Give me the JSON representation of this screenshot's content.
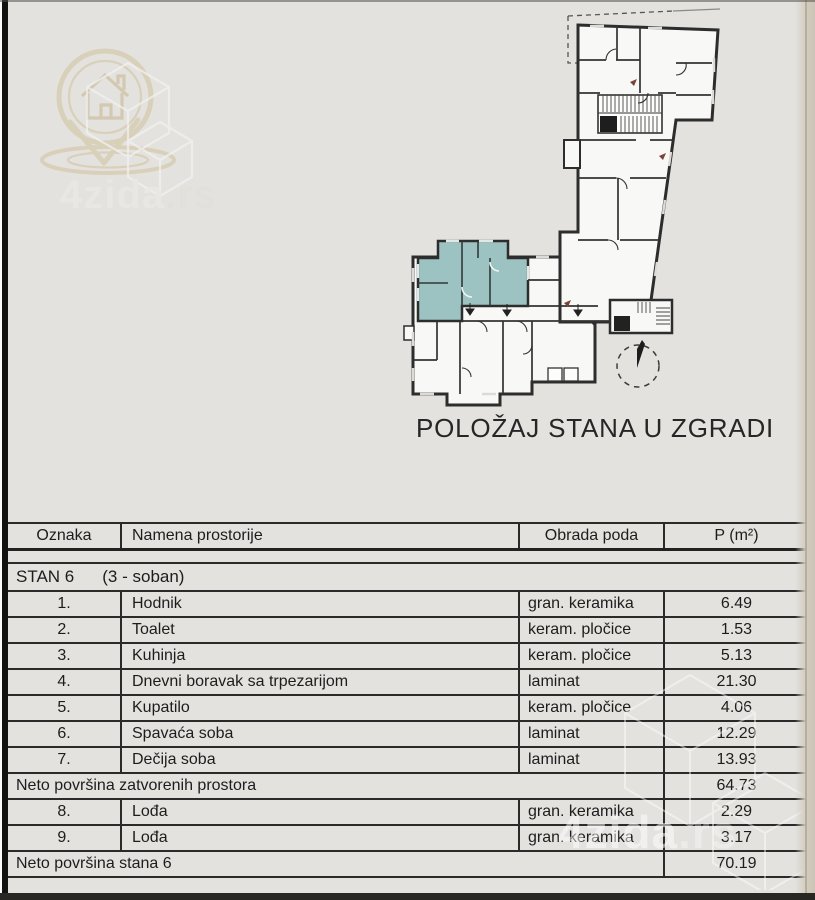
{
  "brand": {
    "name": "4zida",
    "suffix": ".rs"
  },
  "plan": {
    "caption": "POLOŽAJ STANA U ZGRADI",
    "highlight_color": "#9cc3c1",
    "icons": [
      "north-compass-icon",
      "map-pin-house-icon",
      "cube-watermark-icon",
      "stairs-icon",
      "door-swing-icon",
      "entrance-arrow-icon",
      "unit-pointer-marks"
    ]
  },
  "table": {
    "columns": {
      "oznaka": "Oznaka",
      "namena": "Namena prostorije",
      "obrada": "Obrada poda",
      "p": "P (m²)"
    },
    "section": {
      "label": "STAN 6",
      "rooms": "(3 - soban)"
    },
    "rows": [
      {
        "oznaka": "1.",
        "namena": "Hodnik",
        "obrada": "gran. keramika",
        "p": "6.49"
      },
      {
        "oznaka": "2.",
        "namena": "Toalet",
        "obrada": "keram. pločice",
        "p": "1.53"
      },
      {
        "oznaka": "3.",
        "namena": "Kuhinja",
        "obrada": "keram. pločice",
        "p": "5.13"
      },
      {
        "oznaka": "4.",
        "namena": "Dnevni boravak sa trpezarijom",
        "obrada": "laminat",
        "p": "21.30"
      },
      {
        "oznaka": "5.",
        "namena": "Kupatilo",
        "obrada": "keram. pločice",
        "p": "4.06"
      },
      {
        "oznaka": "6.",
        "namena": "Spavaća soba",
        "obrada": "laminat",
        "p": "12.29"
      },
      {
        "oznaka": "7.",
        "namena": "Dečija soba",
        "obrada": "laminat",
        "p": "13.93"
      },
      {
        "type": "summary",
        "namena": "Neto površina zatvorenih prostora",
        "p": "64.73"
      },
      {
        "oznaka": "8.",
        "namena": "Lođa",
        "obrada": "gran. keramika",
        "p": "2.29"
      },
      {
        "oznaka": "9.",
        "namena": "Lođa",
        "obrada": "gran. keramika",
        "p": "3.17"
      },
      {
        "type": "summary",
        "namena": "Neto površina stana 6",
        "p": "70.19"
      }
    ]
  }
}
